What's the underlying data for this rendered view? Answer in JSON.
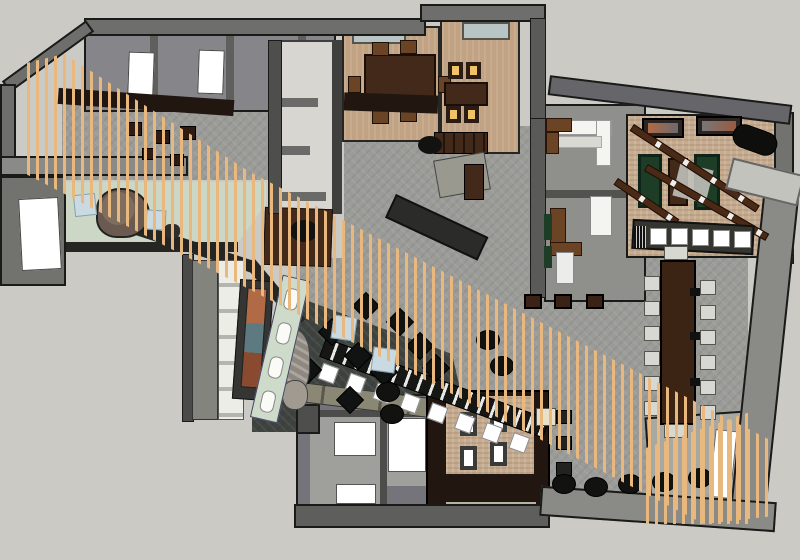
{
  "scene": {
    "title": "Overhead 3D rendering of a restaurant interior floor plan",
    "style": "sketchup-style top-down axonometric model, no visible text",
    "signature_feature": "diagonal timber slat screen crossing the plan from upper-left to lower-right"
  },
  "palette": {
    "bg": "#cbcac4",
    "wallLight": "#8a8a86",
    "wallMid": "#6e6e6c",
    "wallDark": "#4a4a48",
    "outline": "#1a1a18",
    "corridor": "#d7d6d1",
    "carpet": "#9b9b98",
    "tan": "#c1a383",
    "brick": "#c5ac90",
    "woodDark": "#43291a",
    "woodMedium": "#6b4426",
    "espresso": "#221610",
    "slat": "#e9b87e",
    "mint": "#ccd7c6",
    "glass": "#cfdbca",
    "tableBlue": "#c9dae3",
    "lounge": "#3e4340",
    "black": "#121210",
    "felt": "#1e3d26",
    "amber": "#f0c366",
    "white": "#ffffff",
    "skylight": "#b8c5c4",
    "taupe": "#8a8774",
    "stone": "#8e887f",
    "muralOrange": "#b06a45",
    "muralTeal": "#5d7a80",
    "officeFloor": "#8f8f8c",
    "restroomFloor": "#9f9f9b"
  },
  "rooms": [
    {
      "id": "back-of-house",
      "label": "Back-of-house rooms",
      "doors_white": 2
    },
    {
      "id": "corridor",
      "label": "Light corridor with partition fins",
      "fins": 3
    },
    {
      "id": "private-dining-1",
      "label": "Private dining room with wood table",
      "chairs": 6,
      "skylights": 1
    },
    {
      "id": "private-dining-2",
      "label": "Private dining room with amber-lit chairs",
      "chairs": 4,
      "skylights": 1
    },
    {
      "id": "open-kitchen",
      "label": "Service / open kitchen zone"
    },
    {
      "id": "office-suite",
      "label": "Two small office/lounge rooms",
      "rooms": 2
    },
    {
      "id": "games-room",
      "label": "Games room",
      "pool_tables": 2,
      "shuffleboard_tables": 1,
      "track_light_beams": 3,
      "bar_stools": 5,
      "wall_artworks": 2
    },
    {
      "id": "main-hall",
      "label": "Main dining hall with gray carpet"
    },
    {
      "id": "communal-table",
      "label": "Long communal dining table",
      "side_chairs": 12,
      "head_chairs": 2,
      "table_fixtures": 3
    },
    {
      "id": "diagonal-bar",
      "label": "Diagonal bar counter",
      "stools": 8
    },
    {
      "id": "lounge",
      "label": "Sunken lounge",
      "club_chairs": 9,
      "side_tables": 2,
      "ottomans": 4,
      "features": [
        "stone fireplace",
        "orange-teal mural",
        "glass panel wall"
      ]
    },
    {
      "id": "reception",
      "label": "Reception with curved desk",
      "seat_cubes": 2
    },
    {
      "id": "restrooms",
      "label": "Restroom block",
      "doors_white": 3
    },
    {
      "id": "booth-room",
      "label": "Booth dining nook",
      "chairs": 4
    },
    {
      "id": "slat-screen",
      "label": "Diagonal timber slat screen feature"
    },
    {
      "id": "floor-ottomans",
      "label": "Round ottomans along south wall",
      "count": 5
    },
    {
      "id": "nook-tables",
      "label": "Small two-top tables along slat wall",
      "count": 5
    }
  ],
  "counts": {
    "private_dining_1_chairs": 6,
    "private_dining_2_chairs": 4,
    "games_room_bar_stools": 5,
    "pool_tables": 2,
    "communal_side_chairs": 12,
    "diagonal_bar_stools": 8,
    "lounge_club_chairs": 9,
    "lounge_side_tables": 2,
    "lounge_ottomans": 4,
    "floor_ottomans": 5,
    "restroom_doors": 3,
    "booth_chairs": 4,
    "track_light_beams": 3,
    "wall_artworks": 2,
    "skylights": 2
  }
}
